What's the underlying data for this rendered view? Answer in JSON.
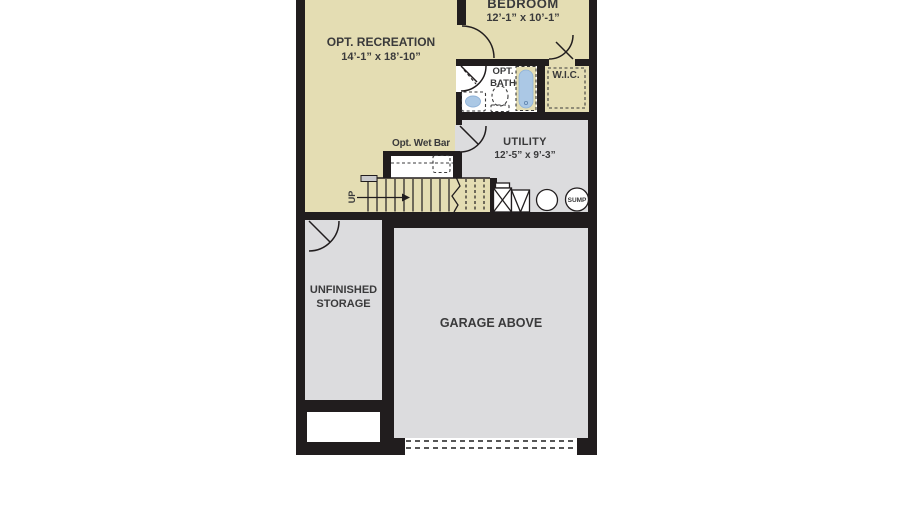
{
  "plan": {
    "title": "basement-floor-plan",
    "rooms": {
      "recreation": {
        "name": "OPT. RECREATION",
        "dims": "14’-1” x 18’-10”"
      },
      "bedroom": {
        "name": "BEDROOM",
        "dims": "12’-1” x 10’-1”"
      },
      "bath": {
        "name": "OPT. BATH"
      },
      "wic": {
        "name": "W.I.C."
      },
      "utility": {
        "name": "UTILITY",
        "dims": "12’-5” x 9’-3”"
      },
      "wet_bar": {
        "name": "Opt. Wet Bar"
      },
      "storage": {
        "name": "UNFINISHED STORAGE"
      },
      "garage": {
        "name": "GARAGE ABOVE"
      }
    },
    "labels": {
      "stairs_direction": "UP",
      "sump_pump": "SUMP"
    },
    "colors": {
      "floor_tan": "#e4ddb3",
      "floor_gray": "#dcdcde",
      "wall_black": "#211d1e",
      "fixture_blue": "#abc8e5",
      "text": "#3a3a3b",
      "background": "#ffffff"
    }
  }
}
